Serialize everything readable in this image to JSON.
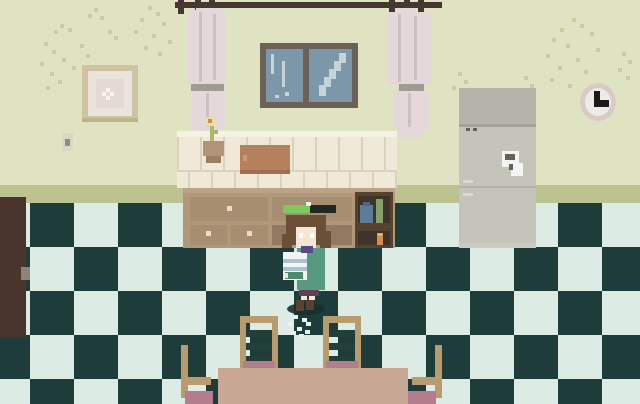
{
  "scene": {
    "type": "pixel-art-kitchen",
    "entities": [
      "door",
      "picture-frame",
      "light-switch",
      "window",
      "curtains",
      "curtain-rod",
      "clock",
      "refrigerator",
      "counter-cabinet",
      "cutting-board",
      "potted-flower",
      "shelf-jar",
      "shelf-bottle",
      "shelf-candle",
      "character",
      "progress-bar",
      "dining-table",
      "ladder-chairs",
      "side-chairs",
      "floor-crumbs",
      "wall-vines"
    ]
  },
  "hud": {
    "progress_percent": 51
  },
  "colors": {
    "wall": "#dfe3c1",
    "baseboard": "#bdc291",
    "floor_light": "#dcebe4",
    "floor_dark": "#1e3c3a",
    "curtain": "#e5d8da",
    "curtain_fold": "#cfbfc3",
    "curtain_tie": "#a09a95",
    "rod": "#463831",
    "window_frame": "#6b6156",
    "window_pane": "#7b97a9",
    "window_streak": "#c5d4d9",
    "frame_outer": "#cfc3a4",
    "frame_shadow": "#bdb28e",
    "frame_mat": "#ebe4dc",
    "frame_art": "#e4d9d5",
    "frame_flower": "#f7f3ef",
    "switch_plate": "#d9d7c6",
    "switch_toggle": "#8e8d7f",
    "fridge_top": "#b4b4aa",
    "fridge_body": "#c4c4bb",
    "fridge_divider": "#a3a399",
    "fridge_divider2": "#b2b2a8",
    "fridge_handle": "#d8d8cf",
    "fridge_kick": "#cbcbc2",
    "fridge_note": "#f4f4f0",
    "fridge_detail": "#62625a",
    "clock_ring": "#d8cac7",
    "clock_face": "#efebe4",
    "clock_hands": "#1a1a1a",
    "counter_tile": "#efe9d8",
    "counter_grout": "#d9d2bd",
    "counter_edge": "#f5f1e3",
    "cabinet": "#b1987b",
    "cabinet_lip": "#bca385",
    "cabinet_dark": "#92795f",
    "drawer": "#a78e71",
    "knob": "#e9dfc8",
    "shelf_frame": "#55422f",
    "shelf_interior": "#40332a",
    "jar_blue": "#5c7d99",
    "jar_lid": "#4a6a84",
    "bottle_green": "#85a06b",
    "candle_orange": "#d98c4b",
    "candle_top": "#e8b06a",
    "board": "#b5805d",
    "board_shade": "#a06f50",
    "board_notch": "#c89a76",
    "pot": "#b29478",
    "pot_shade": "#9c7f63",
    "stem": "#a9b967",
    "flower": "#ecdf9e",
    "flower_center": "#d28a4d",
    "door": "#4a352c",
    "door_knob": "#8d8378",
    "table": "#c8a795",
    "chair_wood": "#b99c6e",
    "chair_slat": "#223f3c",
    "cushion": "#b27d8d",
    "hair": "#6b5038",
    "skin": "#f4e6d5",
    "eye": "#ffffff",
    "dress": "#579a7f",
    "dress_dark": "#4a8a70",
    "collar": "#584a87",
    "bundle": "#f2f4f1",
    "bundle_stripe": "#a9c3d6",
    "skirt": "#5e4152",
    "boot": "#5d4130",
    "shadow": "#16302e",
    "crumb": "#e9f3ee",
    "vine": "#c7ce9d",
    "bar_fill": "#7cc95d",
    "bar_empty": "#20291f",
    "bar_notch": "#f2f4ef"
  }
}
